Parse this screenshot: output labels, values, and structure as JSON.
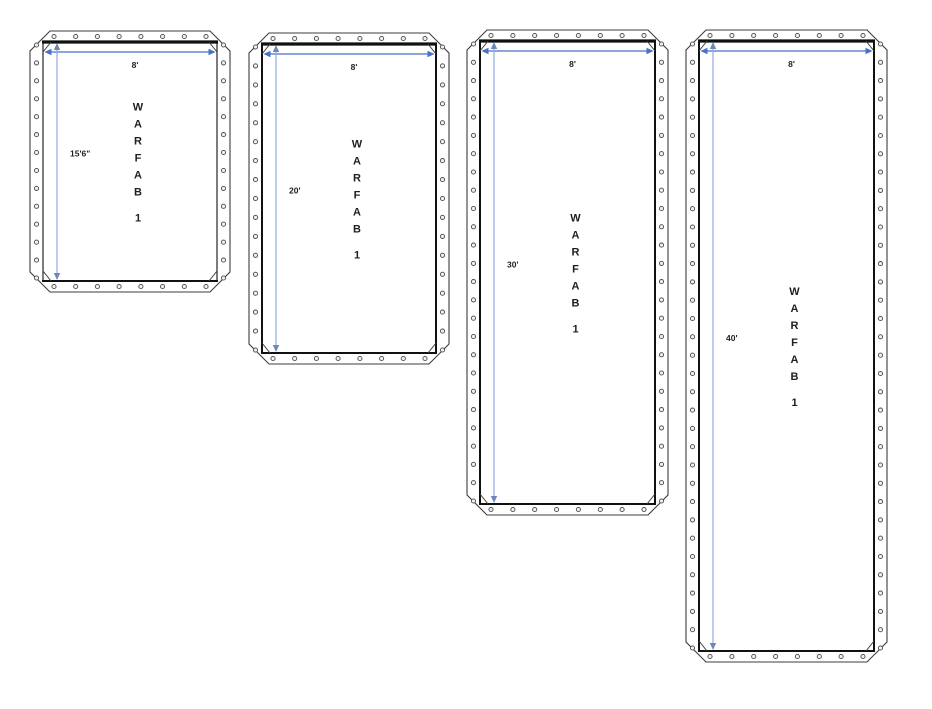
{
  "diagram": {
    "description": "Four WARFAB tarp panel drawings with grommeted hemmed edges and dimension arrows",
    "colors": {
      "background": "#ffffff",
      "outline": "#3d3d3d",
      "inner_edge": "#111111",
      "h_dim": "#4472c4",
      "v_dim": "#8faadc",
      "v_dim_head": "#6d87bd",
      "label": "#1f1f1f",
      "grommet_stroke": "#4a4a4a",
      "grommet_fill": "#f0f0f0"
    },
    "panels": [
      {
        "id": "panel-8ft-x-15ft6",
        "x": 30,
        "y": 31,
        "w": 200,
        "h": 261,
        "width_label": "8'",
        "height_label": "15'6\"",
        "letters": [
          "W",
          "A",
          "R",
          "F",
          "A",
          "B"
        ],
        "number": "1",
        "side_weight": 1.1
      },
      {
        "id": "panel-8ft-x-20ft",
        "x": 249,
        "y": 33,
        "w": 200,
        "h": 331,
        "width_label": "8'",
        "height_label": "20'",
        "letters": [
          "W",
          "A",
          "R",
          "F",
          "A",
          "B"
        ],
        "number": "1",
        "side_weight": 2
      },
      {
        "id": "panel-8ft-x-30ft",
        "x": 467,
        "y": 30,
        "w": 201,
        "h": 485,
        "width_label": "8'",
        "height_label": "30'",
        "letters": [
          "W",
          "A",
          "R",
          "F",
          "A",
          "B"
        ],
        "number": "1",
        "side_weight": 2
      },
      {
        "id": "panel-8ft-x-40ft",
        "x": 686,
        "y": 30,
        "w": 201,
        "h": 632,
        "width_label": "8'",
        "height_label": "40'",
        "letters": [
          "W",
          "A",
          "R",
          "F",
          "A",
          "B"
        ],
        "number": "1",
        "side_weight": 2
      }
    ]
  }
}
